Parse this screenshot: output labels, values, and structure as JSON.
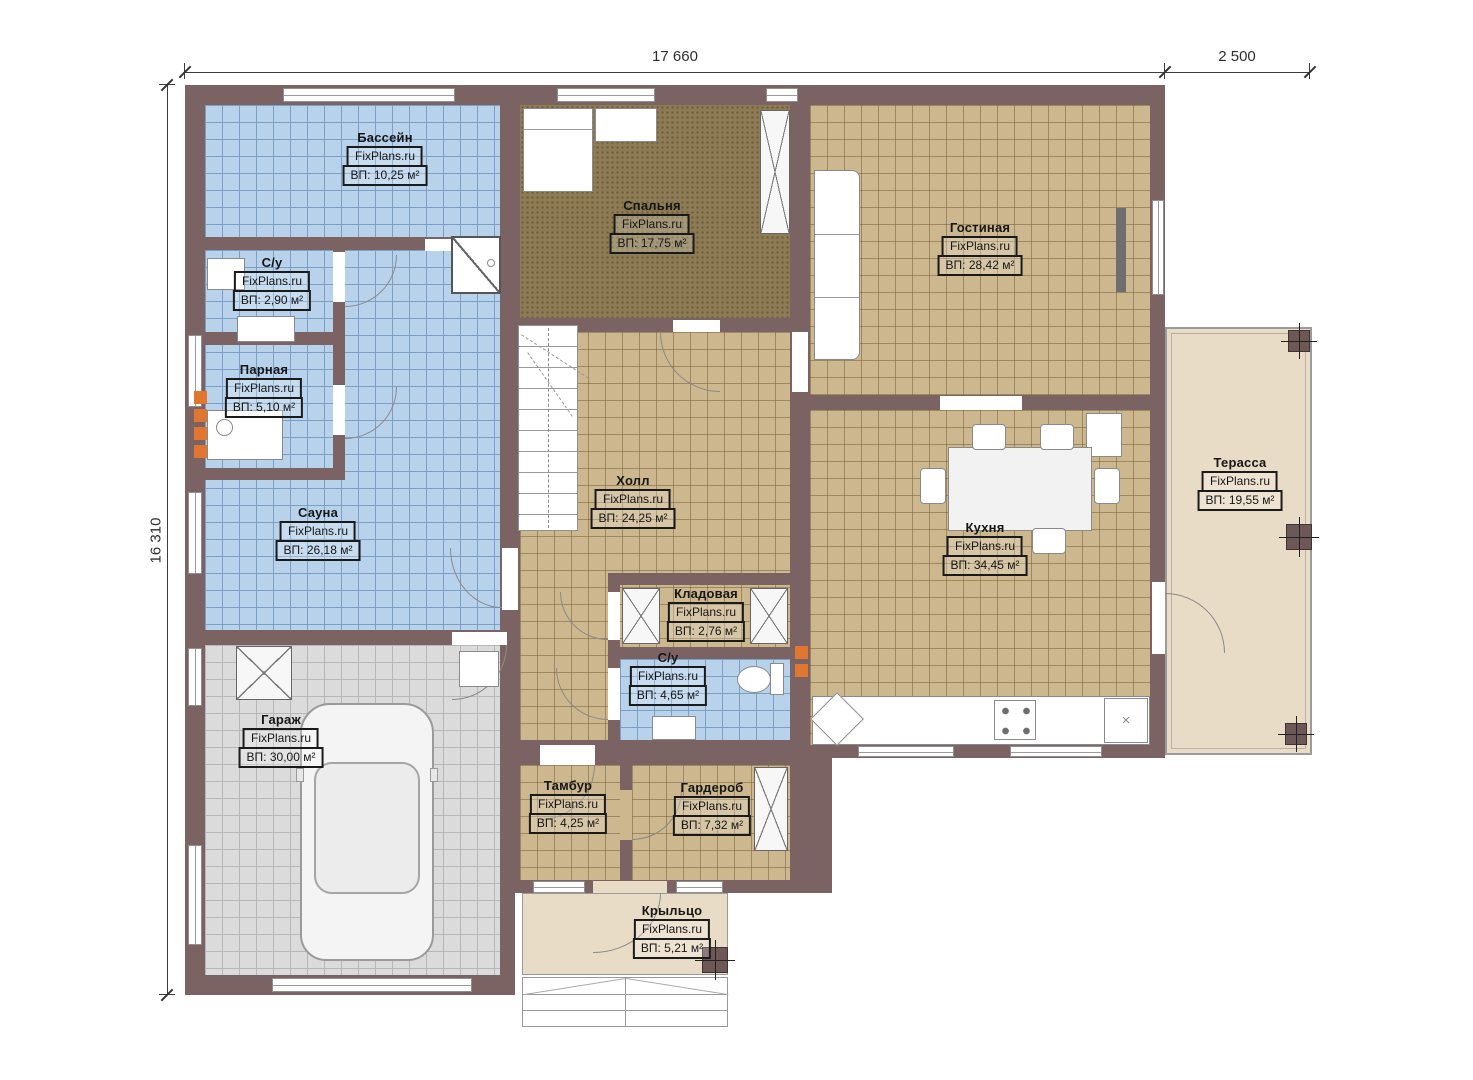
{
  "watermark": "FixPlans.ru",
  "dimensions": {
    "width_main": "17 660",
    "width_terrace": "2 500",
    "height_left": "16 310"
  },
  "rooms": [
    {
      "name": "Бассейн",
      "area": "ВП: 10,25 м²"
    },
    {
      "name": "С/у",
      "area": "ВП: 2,90 м²"
    },
    {
      "name": "Парная",
      "area": "ВП: 5,10 м²"
    },
    {
      "name": "Сауна",
      "area": "ВП: 26,18 м²"
    },
    {
      "name": "Гараж",
      "area": "ВП: 30,00 м²"
    },
    {
      "name": "Спальня",
      "area": "ВП: 17,75 м²"
    },
    {
      "name": "Гостиная",
      "area": "ВП: 28,42 м²"
    },
    {
      "name": "Холл",
      "area": "ВП: 24,25 м²"
    },
    {
      "name": "Кухня",
      "area": "ВП: 34,45 м²"
    },
    {
      "name": "Кладовая",
      "area": "ВП: 2,76 м²"
    },
    {
      "name": "С/у",
      "area": "ВП: 4,65 м²"
    },
    {
      "name": "Тамбур",
      "area": "ВП: 4,25 м²"
    },
    {
      "name": "Гардероб",
      "area": "ВП: 7,32 м²"
    },
    {
      "name": "Крыльцо",
      "area": "ВП: 5,21 м²"
    },
    {
      "name": "Терасса",
      "area": "ВП: 19,55 м²"
    }
  ],
  "symbols": {
    "x_marker": "×"
  },
  "colors": {
    "wall": "#7b6363",
    "wet_tile": "#b9d2ec",
    "floor_tile": "#ccb78e",
    "bedroom_carpet": "#8c7b54",
    "garage_floor": "#dbdbdc",
    "terrace": "#e9dcc6",
    "accent_orange": "#e0762f"
  }
}
